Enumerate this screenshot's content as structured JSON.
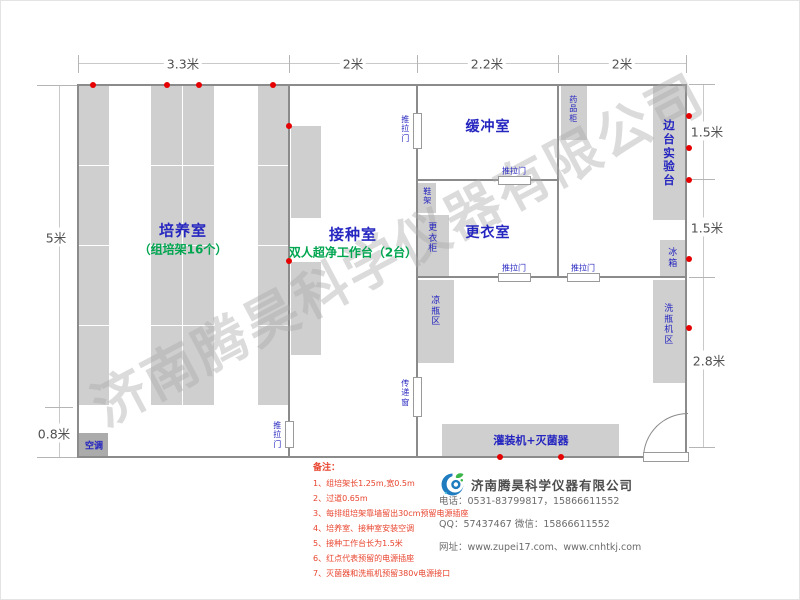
{
  "watermark": {
    "text": "济南腾昊科学仪器有限公司"
  },
  "dimensions": {
    "top_1": "3.3米",
    "top_2": "2米",
    "top_3": "2.2米",
    "top_4": "2米",
    "left_1": "5米",
    "left_2": "0.8米",
    "right_1": "1.5米",
    "right_2": "1.5米",
    "right_3": "2.8米"
  },
  "rooms": {
    "cultivation_name": "培养室",
    "cultivation_sub": "（组培架16个）",
    "inoculation_name": "接种室",
    "inoculation_sub": "双人超净工作台（2台）",
    "buffer_name": "缓冲室",
    "changing_name": "更衣室"
  },
  "labels": {
    "sliding_door": "推拉门",
    "pass_window": "传递窗",
    "shoe_rack": "鞋架",
    "locker": "更衣柜",
    "medicine_cabinet": "药品柜",
    "side_bench": "边台实验台",
    "fridge": "冰箱",
    "cooling_bottle_area": "凉瓶区",
    "bottle_washer_area": "洗瓶机区",
    "filling_machine": "灌装机+灭菌器",
    "air_conditioner": "空调"
  },
  "notes": {
    "title": "备注：",
    "items": [
      "1、组培架长1.25m,宽0.5m",
      "2、过道0.65m",
      "3、每排组培架靠墙留出30cm预留电源插座",
      "4、培养室、接种室安装空调",
      "5、接种工作台长为1.5米",
      "6、红点代表预留的电源插座",
      "7、灭菌器和洗瓶机预留380v电源接口"
    ]
  },
  "company": {
    "name": "济南腾昊科学仪器有限公司",
    "phone_line": "电话：0531-83799817，15866611552",
    "qq_line": "QQ：57437467    微信：15866611552",
    "web_line": "网址：www.zupei17.com、www.cnhtkj.com"
  },
  "colors": {
    "accent_blue": "#2525c0",
    "accent_green": "#00a550",
    "note_red": "#e8442e",
    "dot_red": "#e60000",
    "wall_gray": "#8b8b8b"
  }
}
